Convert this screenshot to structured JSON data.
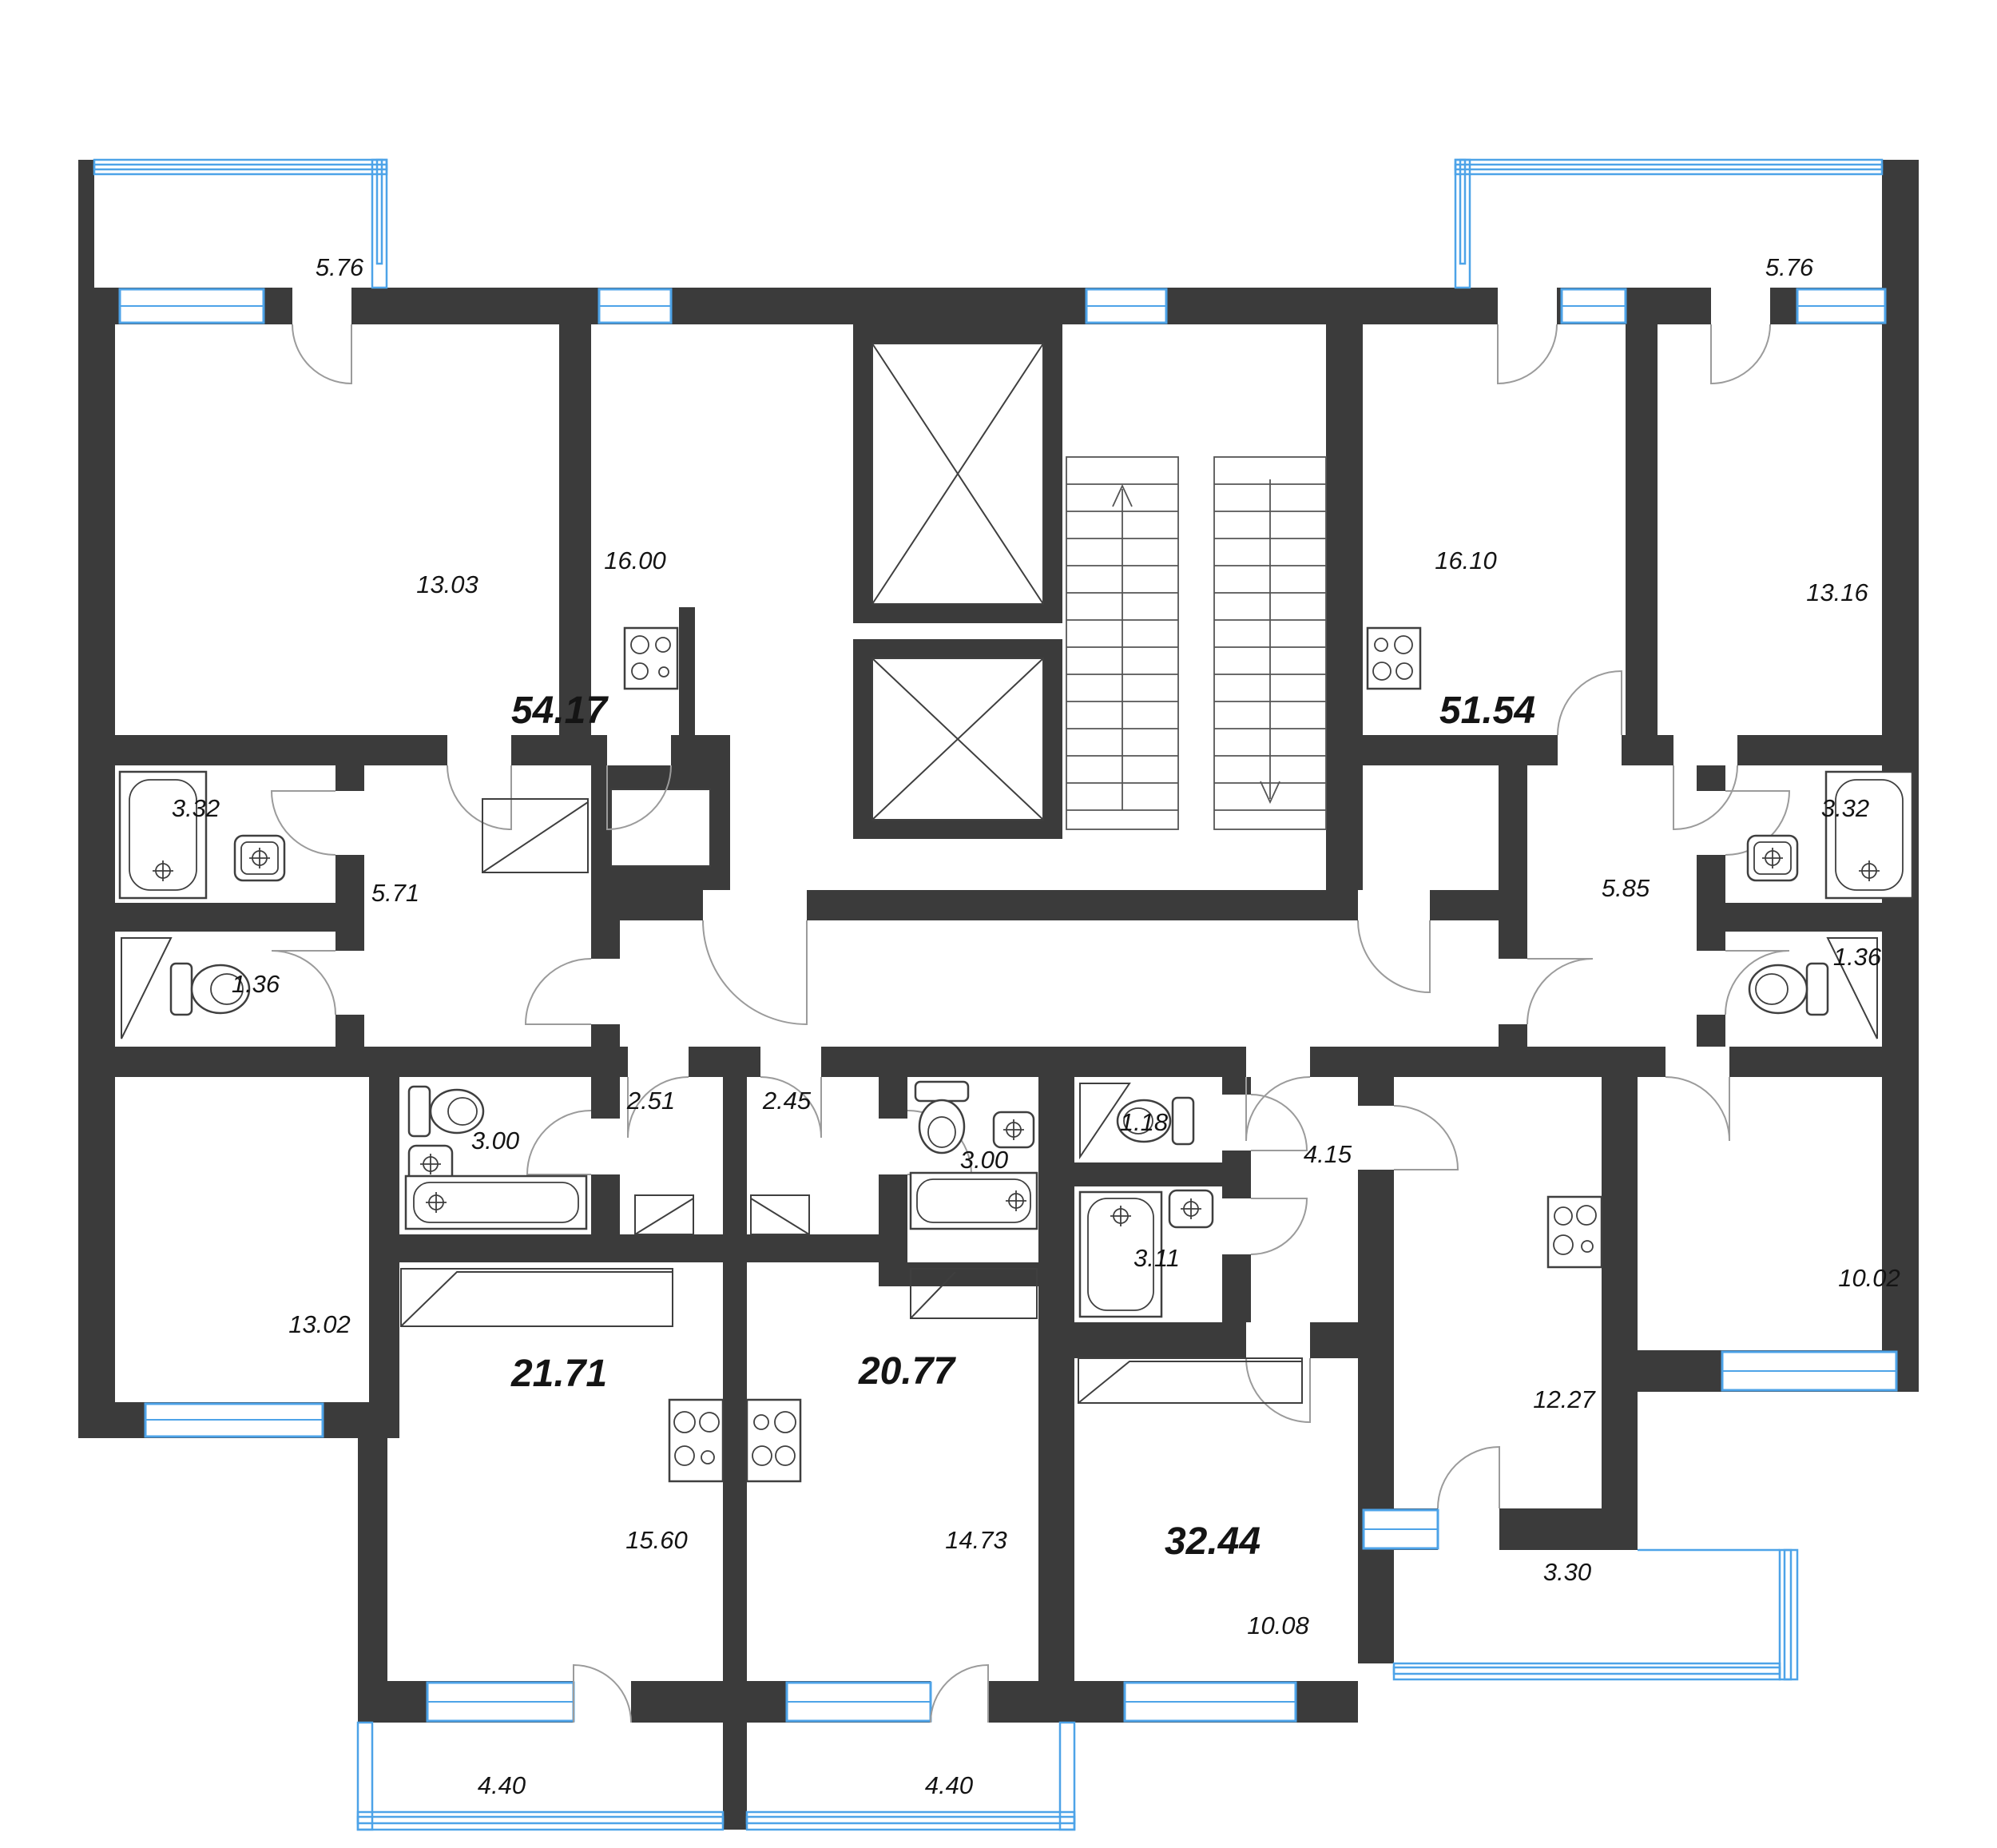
{
  "plan_type": "residential-floor-plan",
  "colors": {
    "wall": "#3b3b3b",
    "window": "#4da3e8",
    "door_arc": "#9b9b9b",
    "fixture_stroke": "#3f3f3f",
    "label": "#141414"
  },
  "apartments": [
    {
      "name": "apartment-top-left",
      "total_area": "54.17",
      "rooms": {
        "balcony": "5.76",
        "room": "13.03",
        "kitchen_living": "16.00",
        "bathroom": "3.32",
        "hall": "5.71",
        "wc": "1.36",
        "bedroom": "13.02"
      }
    },
    {
      "name": "apartment-top-right",
      "total_area": "51.54",
      "rooms": {
        "balcony": "5.76",
        "kitchen_living": "16.10",
        "room": "13.16",
        "bathroom": "3.32",
        "hall": "5.85",
        "wc": "1.36",
        "bedroom": "10.02"
      }
    },
    {
      "name": "apartment-studio-left",
      "total_area": "21.71",
      "rooms": {
        "hall": "2.51",
        "bathroom": "3.00",
        "living": "15.60",
        "balcony": "4.40"
      }
    },
    {
      "name": "apartment-studio-center",
      "total_area": "20.77",
      "rooms": {
        "hall": "2.45",
        "bathroom": "3.00",
        "living": "14.73",
        "balcony": "4.40"
      }
    },
    {
      "name": "apartment-bottom-right",
      "total_area": "32.44",
      "rooms": {
        "wc": "1.18",
        "bathroom": "3.11",
        "hall": "4.15",
        "kitchen_living": "12.27",
        "room": "10.08",
        "balcony": "3.30"
      }
    }
  ]
}
